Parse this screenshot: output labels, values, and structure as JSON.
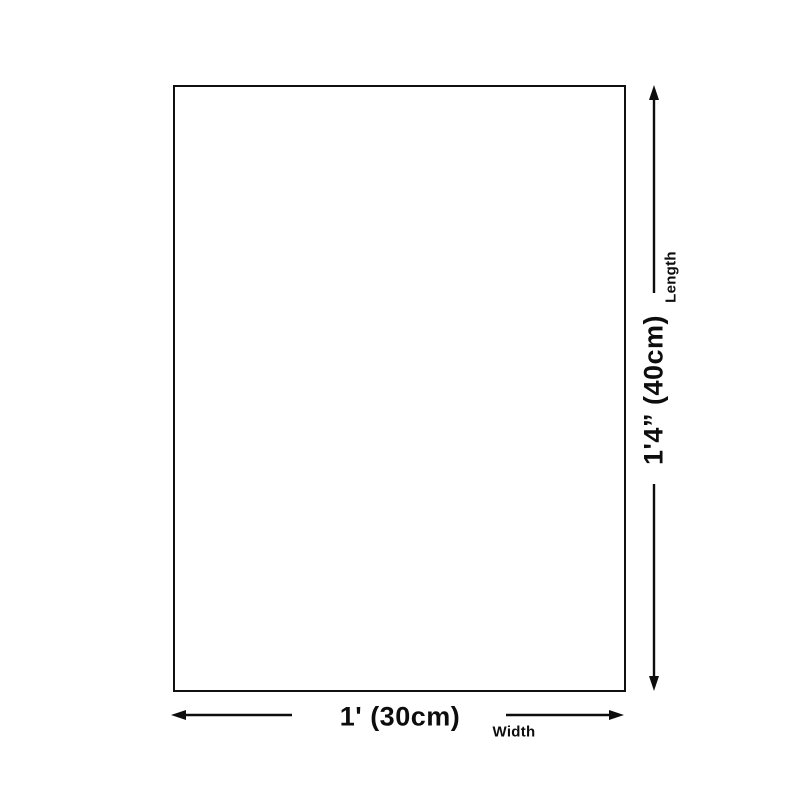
{
  "diagram": {
    "length": {
      "value": "1'4” (40cm)",
      "label": "Length"
    },
    "width": {
      "value": "1' (30cm)",
      "label": "Width"
    },
    "colors": {
      "line": "#0d0d0d",
      "border": "#101010",
      "background": "#ffffff"
    }
  }
}
